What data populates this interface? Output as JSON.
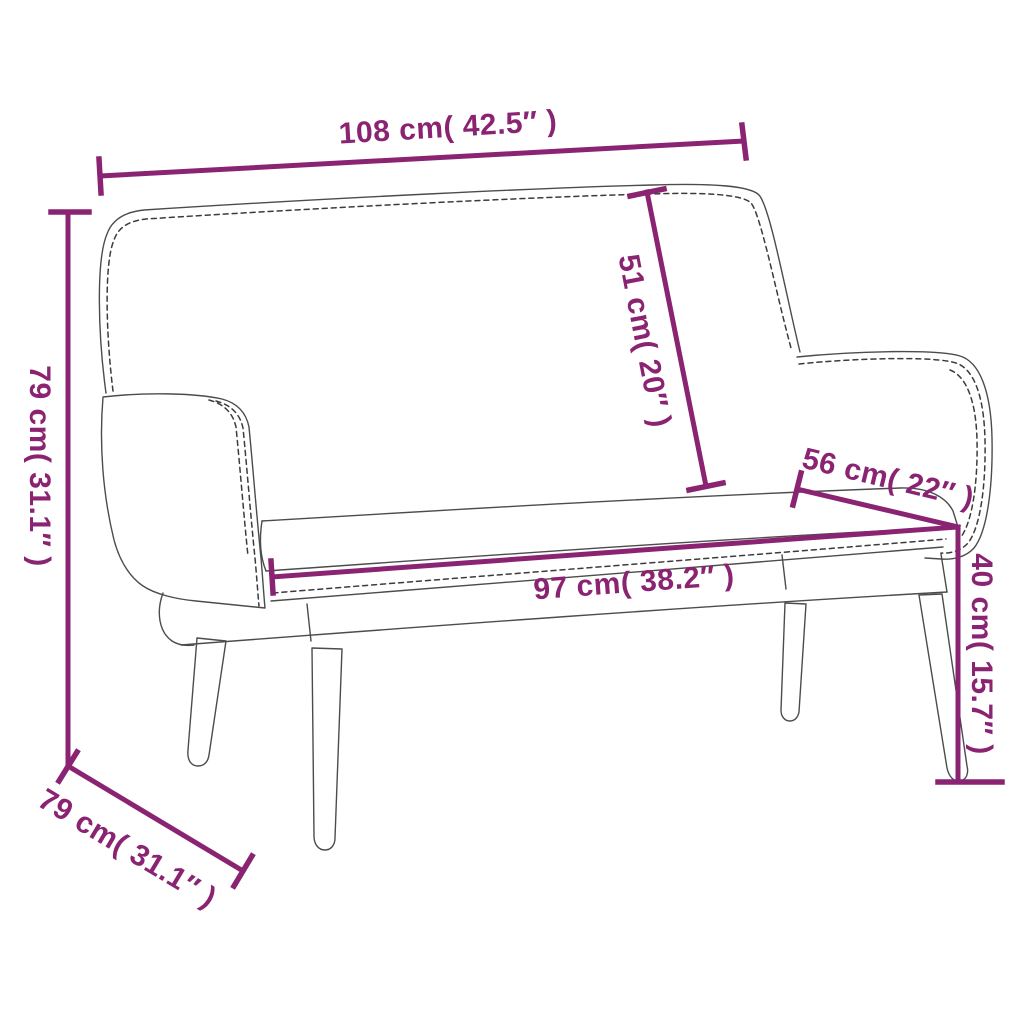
{
  "diagram": {
    "type": "product-dimension-diagram",
    "subject": "upholstered bench with backrest and armrests",
    "colors": {
      "accent": "#8a2472",
      "outline": "#4c4c4c",
      "stitch": "#3c3c3c",
      "background": "#ffffff"
    },
    "dimensions": [
      {
        "id": "overall-width",
        "label": "108 cm( 42.5″ )",
        "cm": 108,
        "inches": 42.5
      },
      {
        "id": "overall-height",
        "label": "79 cm( 31.1″ )",
        "cm": 79,
        "inches": 31.1
      },
      {
        "id": "backrest-height",
        "label": "51 cm( 20″ )",
        "cm": 51,
        "inches": 20
      },
      {
        "id": "seat-depth",
        "label": "56 cm( 22″ )",
        "cm": 56,
        "inches": 22
      },
      {
        "id": "seat-width",
        "label": "97 cm( 38.2″ )",
        "cm": 97,
        "inches": 38.2
      },
      {
        "id": "seat-height",
        "label": "40 cm( 15.7″ )",
        "cm": 40,
        "inches": 15.7
      },
      {
        "id": "overall-depth",
        "label": "79 cm( 31.1″ )",
        "cm": 79,
        "inches": 31.1
      }
    ]
  }
}
